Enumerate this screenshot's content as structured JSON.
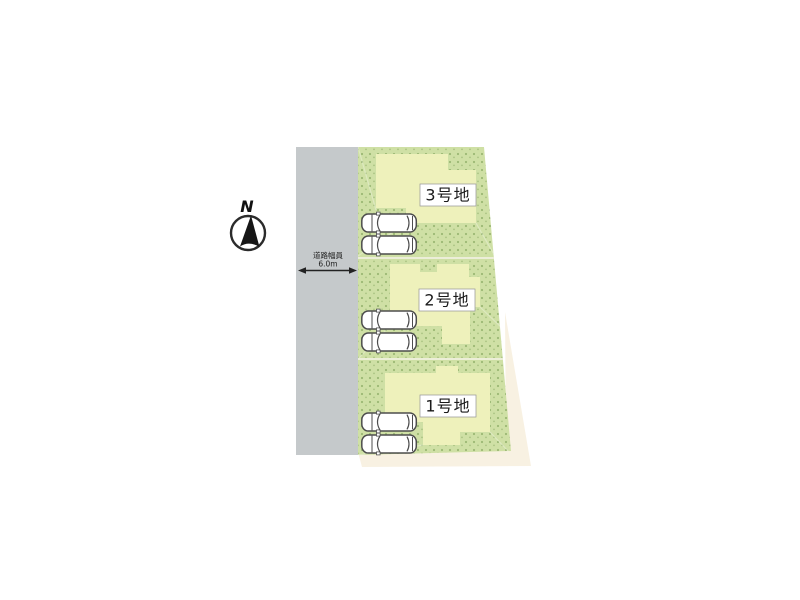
{
  "compass": {
    "label": "N"
  },
  "road": {
    "width_label": "道路幅員",
    "width_value": "6.0m"
  },
  "lots": [
    {
      "label": "1号地"
    },
    {
      "label": "2号地"
    },
    {
      "label": "3号地"
    }
  ],
  "colors": {
    "road": "#c5c9cb",
    "ground": "#cfe0a5",
    "ground_dot_dark": "#9cb874",
    "ground_dot_light": "#aac382",
    "building": "#eef1bb",
    "building_edge": "#e2e6a6",
    "adjacent": "#f8f1e2",
    "divider": "#eceed8",
    "car_outline": "#4d4d4d",
    "ink": "#222222"
  }
}
